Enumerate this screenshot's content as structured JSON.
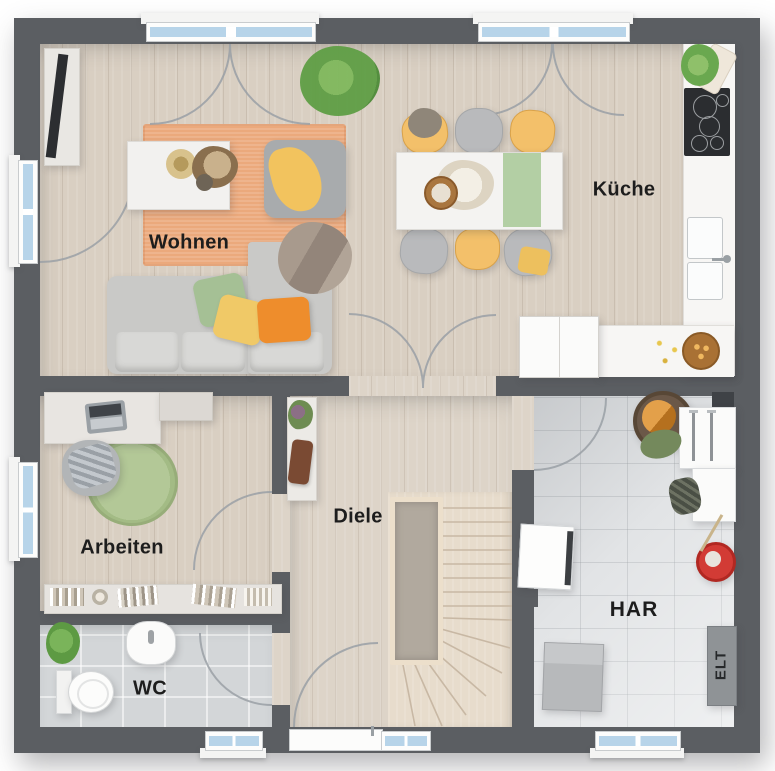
{
  "floorplan": {
    "rooms": {
      "wohnen": {
        "label": "Wohnen"
      },
      "kueche": {
        "label": "Küche"
      },
      "arbeiten": {
        "label": "Arbeiten"
      },
      "diele": {
        "label": "Diele"
      },
      "wc": {
        "label": "WC"
      },
      "har": {
        "label": "HAR"
      },
      "elt": {
        "label": "ELT"
      }
    },
    "colors": {
      "wall": "#5b5e62",
      "wood_floor": "#d9cfc2",
      "tile_floor_wc": "#d3d6d8",
      "tile_floor_har": "#e2e4e6",
      "rug_orange": "#eba97c",
      "rug_green": "#a9c08f",
      "window_glass": "#b7d4e9",
      "accent_yellow": "#f3c06a",
      "accent_orange": "#ee8d2c",
      "accent_green": "#a5c095",
      "bucket_red": "#d23b35",
      "label_text": "#1d1d1d"
    }
  }
}
